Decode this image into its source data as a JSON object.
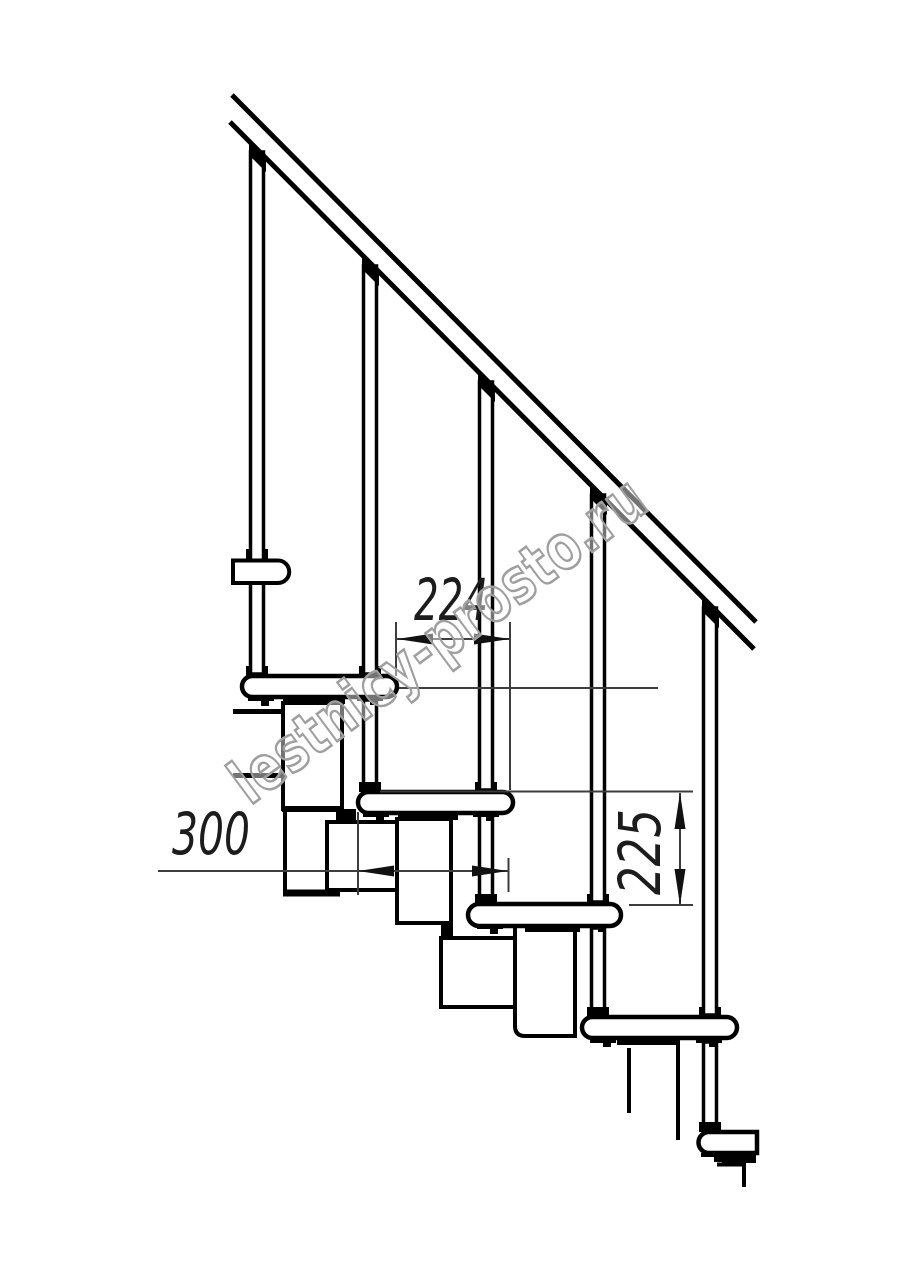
{
  "drawing": {
    "type": "technical-drawing",
    "subject": "modular staircase side elevation with railing",
    "units_scale": "0.5 px per mm",
    "colors": {
      "background": "#ffffff",
      "line": "#000000",
      "dimension_line": "#3d3d3d",
      "dimension_text": "#1c1c1c",
      "watermark_stroke": "#9f9f9f",
      "watermark_fill": "rgba(255,255,255,0.45)"
    },
    "dimensions": [
      {
        "id": "step-offset",
        "value": "224",
        "orientation": "horizontal",
        "measures": "horizontal offset between step noses"
      },
      {
        "id": "tread-depth",
        "value": "300",
        "orientation": "horizontal",
        "measures": "tread depth"
      },
      {
        "id": "riser-height",
        "value": "225",
        "orientation": "vertical",
        "measures": "rise between treads"
      }
    ],
    "watermark": {
      "text": "lestnicy-prosto.ru"
    },
    "counts": {
      "treads_visible": 5,
      "balusters_visible": 5
    }
  }
}
